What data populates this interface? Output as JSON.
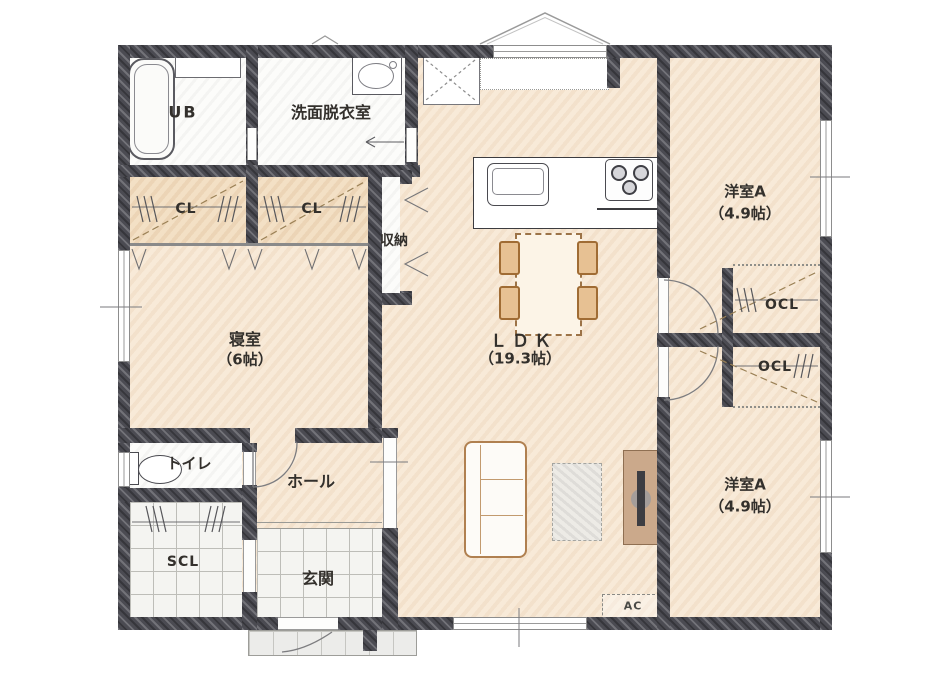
{
  "floorplan": {
    "title": "1-floor residence plan",
    "rooms": {
      "ub": {
        "label": "UB"
      },
      "washroom": {
        "label": "洗面脱衣室"
      },
      "closet_a": {
        "label": "CL"
      },
      "closet_b": {
        "label": "CL"
      },
      "storage": {
        "label": "収納"
      },
      "bedroom": {
        "label": "寝室",
        "size": "（6帖）"
      },
      "toilet": {
        "label": "トイレ"
      },
      "hall": {
        "label": "ホール"
      },
      "shoe_closet": {
        "label": "SCL"
      },
      "entrance": {
        "label": "玄関"
      },
      "ldk": {
        "label": "ＬＤＫ",
        "size": "（19.3帖）"
      },
      "western_room_top": {
        "label": "洋室A",
        "size": "（4.9帖）"
      },
      "western_room_bottom": {
        "label": "洋室A",
        "size": "（4.9帖）"
      },
      "open_closet_top": {
        "label": "OCL"
      },
      "open_closet_bottom": {
        "label": "OCL"
      },
      "air_conditioner": {
        "label": "AC"
      }
    },
    "colors": {
      "wall": "#4b4b52",
      "wood_floor": "#f8ead8",
      "closet_floor": "#f3e0c5",
      "tile_floor": "#f4f4f1",
      "furniture_wood": "#cba98b",
      "line": "#33302c"
    }
  }
}
